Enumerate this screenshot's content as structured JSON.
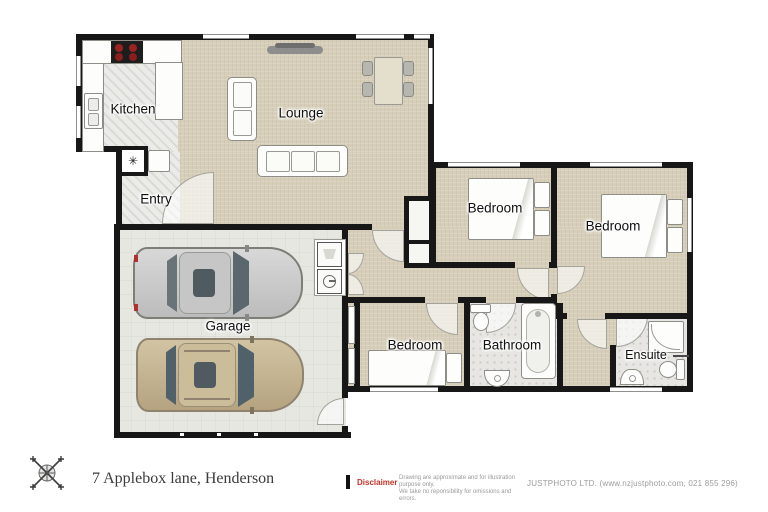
{
  "rooms": {
    "kitchen": "Kitchen",
    "lounge": "Lounge",
    "entry": "Entry",
    "garage": "Garage",
    "bedroom_mid": "Bedroom",
    "bedroom_master": "Bedroom",
    "bedroom_third": "Bedroom",
    "bathroom": "Bathroom",
    "ensuite": "Ensuite"
  },
  "symbols": {
    "hot_water_cupboard": "✳"
  },
  "footer": {
    "address": "7 Applebox lane, Henderson",
    "disclaimer_label": "Disclaimer",
    "disclaimer_line1": "Drawing are approximate and for illustration purpose only.",
    "disclaimer_line2": "We take no reponsibility for omissions and errors.",
    "company": "JUSTPHOTO LTD. (www.nzjustphoto.com, 021 855 296)"
  },
  "colors": {
    "carpet": "#d7ceba",
    "wall": "#171717",
    "disclaimer_red": "#c23028",
    "car_silver": "#c9c9c9",
    "car_tan": "#c2b190"
  }
}
